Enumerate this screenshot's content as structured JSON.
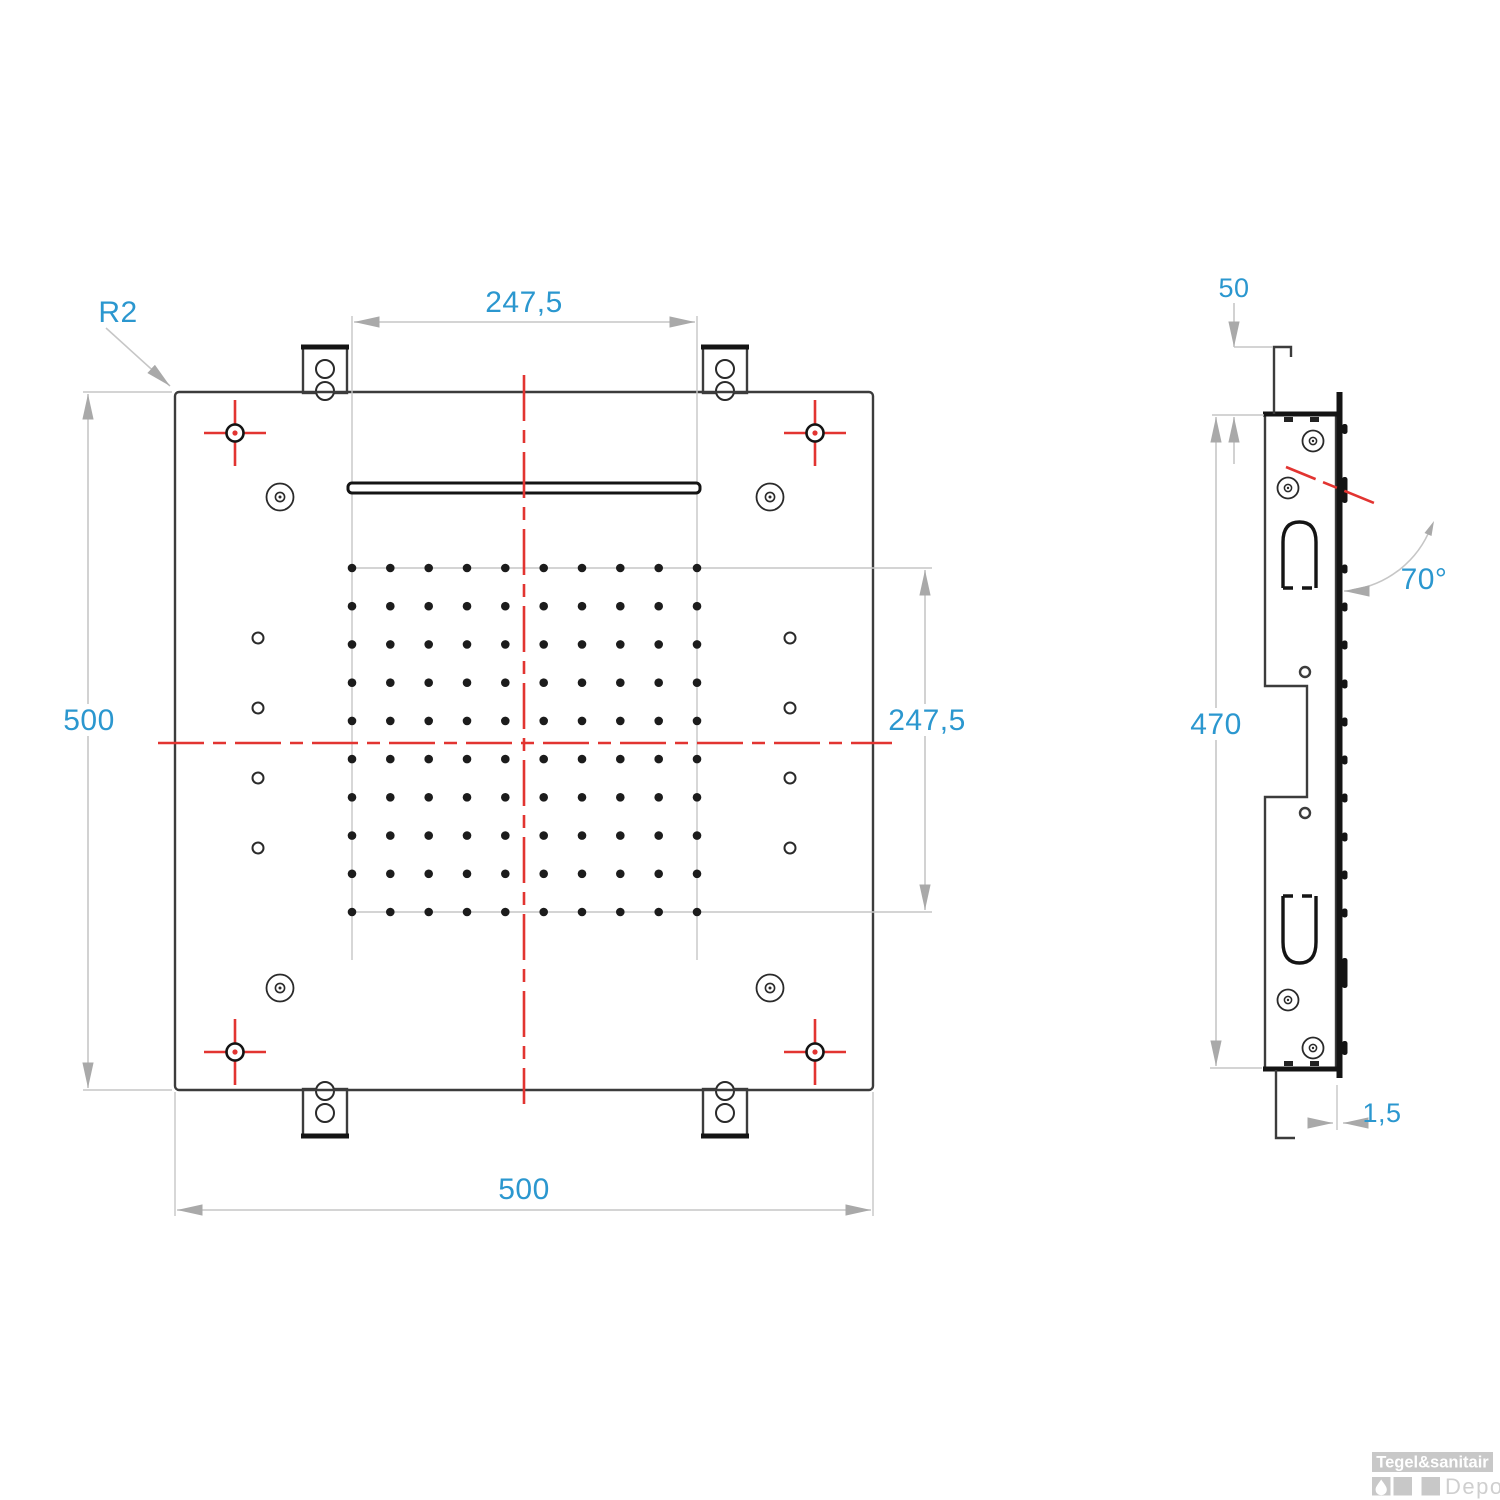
{
  "drawing": {
    "type": "technical-drawing",
    "product": "ceiling rain shower head, two orthographic views",
    "colors": {
      "dimension_text": "#2b97cf",
      "centerline_red": "#e23431",
      "outline": "#3c3c3c",
      "dimension_line": "#c6c6c6",
      "logo_gray": "#c8c8c8"
    },
    "front_view": {
      "labels": {
        "corner_radius": "R2",
        "top_width": "247,5",
        "left_height": "500",
        "right_height": "247,5",
        "bottom_width": "500"
      },
      "nozzle_grid": {
        "rows": 10,
        "cols": 10
      },
      "outer_nozzle_columns": {
        "per_side": 4,
        "sides": 2
      },
      "corner_screws": 4,
      "corner_center_marks": 4,
      "mounting_tabs": 4,
      "tab_holes_per_tab": 2
    },
    "side_view": {
      "labels": {
        "hook_offset": "50",
        "body_height": "470",
        "spray_angle": "70°",
        "plate_thickness": "1,5"
      },
      "screws": 4,
      "slots": 2
    }
  },
  "logo": {
    "brand": "Tegel&sanitair",
    "sub": "Depot"
  }
}
